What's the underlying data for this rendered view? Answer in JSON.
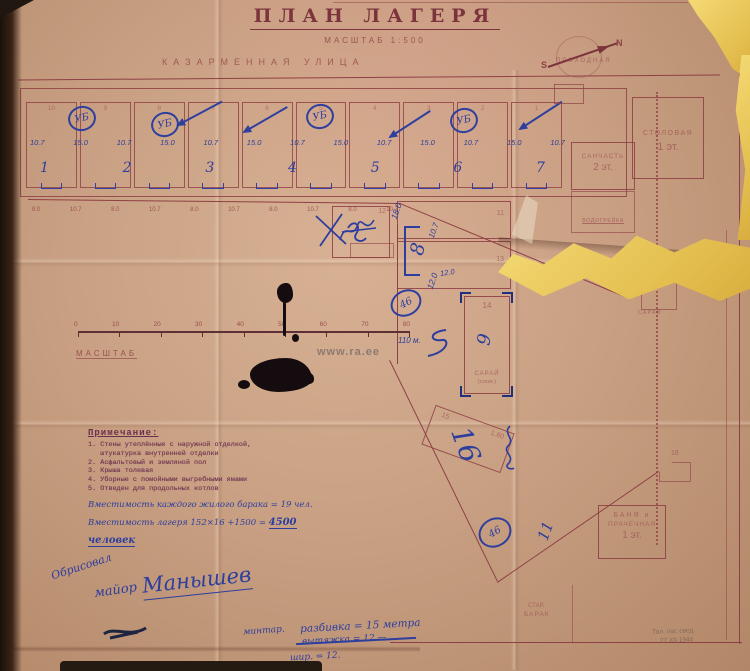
{
  "document": {
    "title": "ПЛАН ЛАГЕРЯ",
    "scale_note": "МАСШТАБ 1:500",
    "street": "КАЗАРМЕННАЯ УЛИЦА",
    "watermark": "www.ra.ee"
  },
  "compass": {
    "s": "S",
    "n": "N"
  },
  "barracks": {
    "top_numbers": [
      "10",
      "9",
      "8",
      "7",
      "6",
      "5",
      "4",
      "3",
      "2",
      "1"
    ],
    "dims": [
      "10.7",
      "15.0",
      "10.7",
      "15.0",
      "10.7",
      "15.0",
      "10.7",
      "15.0",
      "10.7",
      "15.0",
      "10.7",
      "15.0",
      "10.7"
    ],
    "unit_numbers": [
      "1",
      "2",
      "3",
      "4",
      "5",
      "6",
      "7"
    ],
    "latrine_mark": "УБ"
  },
  "fence": {
    "spacings": [
      "8.0",
      "10.7",
      "8.0",
      "10.7",
      "8.0",
      "10.7",
      "8.0",
      "10.7",
      "8.0",
      "10.7"
    ]
  },
  "buildings": {
    "b12": "12",
    "b11": "11",
    "b13": "13",
    "b14": "14",
    "b14_name": "САРАЙ",
    "b14_note": "(слом.)",
    "b8_mark": "8",
    "b9_mark": "9",
    "b15": "15",
    "b15_dim": "1.60",
    "b16_big": "16",
    "b16": "16",
    "dim_18": "18.0",
    "dim_10_7": "10.7",
    "dim_12a": "12.0",
    "dim_12b": "12.0",
    "circle_a": "46",
    "circle_b": "46",
    "mark_11": "11",
    "prohodnaya": "ПРОХОДНАЯ",
    "stolovaya": "СТОЛОВАЯ",
    "stolovaya_fl": "1 эт.",
    "sanchast": "САНЧАСТЬ",
    "sanchast_fl": "2 эт.",
    "vodogreika": "ВОДОГРЕЙКА",
    "saray": "САРАЙ",
    "banya1": "БАНЯ и",
    "banya2": "ПРАЧЕЧНАЯ",
    "banya_fl": "1 эт.",
    "star_barak1": "СТАР.",
    "star_barak2": "БАРАК"
  },
  "scale_bar": {
    "ticks": [
      "0",
      "10",
      "20",
      "30",
      "40",
      "50",
      "60",
      "70",
      "80"
    ],
    "end_note": "110 м.",
    "label": "МАСШТАБ"
  },
  "notes": {
    "title": "Примечание:",
    "lines": [
      "1. Стены утеплённые с наружной отделкой,",
      "   штукатурка внутренней отделки",
      "2. Асфальтовый и земляной пол",
      "3. Крыша толевая",
      "4. Уборные с помойными выгребными ямами",
      "5. Отведен для продольных котлов"
    ],
    "capacity_line1": "Вместимость каждого жилого барака = 19 чел.",
    "capacity_line2": "Вместимость лагеря 152×16 +1500 = ",
    "capacity_total": "4500 человек"
  },
  "handwriting": {
    "verb": "Обрисовал",
    "rank": "майор",
    "name": "Манышев",
    "calc1": "минтар.",
    "calc2": "разбивка = 15 метра",
    "calc3": "вытяжка = 12 —",
    "calc4": "шир. = 12.",
    "pencil1": "Тал. лаг. свед.",
    "pencil2": "27 XII 1944"
  }
}
